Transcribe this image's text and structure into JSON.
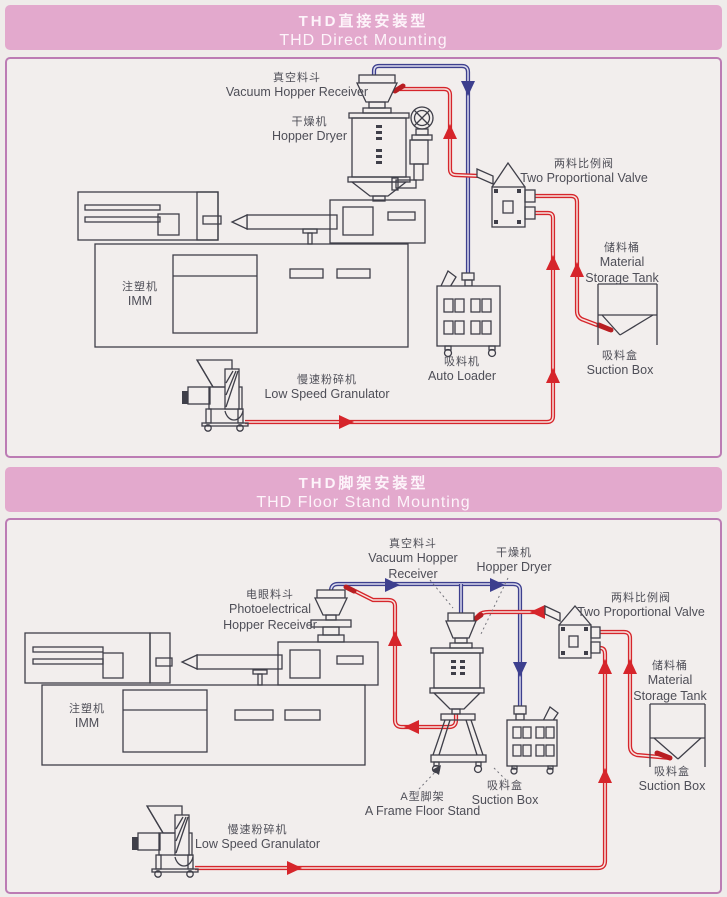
{
  "palette": {
    "header_pink": "#e3a9cd",
    "panel_bg": "#f2eeed",
    "panel_border": "#bc7cb4",
    "pipe_red": "#d6252b",
    "pipe_blue": "#3d3f8e",
    "line_color": "#3f3f49",
    "label_color": "#4e4e57"
  },
  "sections": [
    {
      "header": {
        "title_cn": "THD直接安装型",
        "title_en": "THD Direct Mounting"
      },
      "labels": {
        "vacuum_hopper": {
          "cn": "真空料斗",
          "en": "Vacuum Hopper Receiver"
        },
        "hopper_dryer": {
          "cn": "干燥机",
          "en": "Hopper Dryer"
        },
        "two_prop_valve": {
          "cn": "两料比例阀",
          "en": "Two Proportional Valve"
        },
        "storage_tank": {
          "cn": "储料桶",
          "en1": "Material",
          "en2": "Storage Tank"
        },
        "auto_loader": {
          "cn": "吸料机",
          "en": "Auto Loader"
        },
        "suction_box": {
          "cn": "吸料盒",
          "en": "Suction Box"
        },
        "imm": {
          "cn": "注塑机",
          "en": "IMM"
        },
        "granulator": {
          "cn": "慢速粉碎机",
          "en": "Low Speed Granulator"
        }
      }
    },
    {
      "header": {
        "title_cn": "THD脚架安装型",
        "title_en": "THD Floor Stand Mounting"
      },
      "labels": {
        "vacuum_hopper": {
          "cn": "真空料斗",
          "en1": "Vacuum Hopper",
          "en2": "Receiver"
        },
        "hopper_dryer": {
          "cn": "干燥机",
          "en": "Hopper Dryer"
        },
        "photoelectrical": {
          "cn": "电眼料斗",
          "en1": "Photoelectrical",
          "en2": "Hopper Receiver"
        },
        "two_prop_valve": {
          "cn": "两料比例阀",
          "en": "Two Proportional Valve"
        },
        "storage_tank": {
          "cn": "储料桶",
          "en1": "Material",
          "en2": "Storage Tank"
        },
        "suction_box_tank": {
          "cn": "吸料盒",
          "en": "Suction Box"
        },
        "suction_box_machine": {
          "cn": "吸料盒",
          "en": "Suction Box"
        },
        "a_frame": {
          "cn": "A型脚架",
          "en": "A Frame Floor Stand"
        },
        "imm": {
          "cn": "注塑机",
          "en": "IMM"
        },
        "granulator": {
          "cn": "慢速粉碎机",
          "en": "Low Speed Granulator"
        }
      }
    }
  ]
}
